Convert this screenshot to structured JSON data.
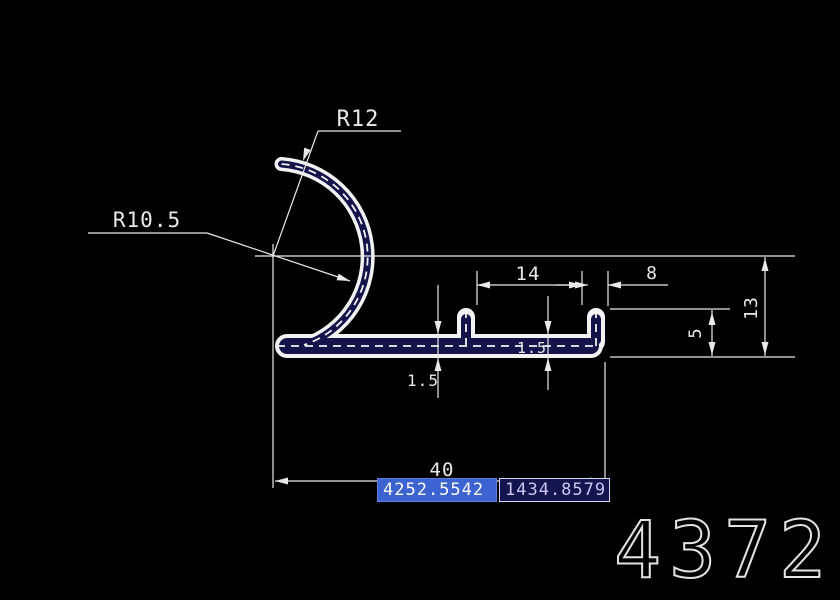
{
  "labels": {
    "radius_outer": "R12",
    "radius_inner": "R10.5"
  },
  "dimensions": {
    "tab_to_lip": "14",
    "lip_width": "8",
    "right_height": "13",
    "lip_height": "5",
    "wall_thickness_left": "1.5",
    "wall_thickness_right": "1.5",
    "overall_width": "40"
  },
  "dynamic_input": {
    "x_coordinate": "4252.5542",
    "y_coordinate": "1434.8579"
  },
  "drawing_number": "4372",
  "colors": {
    "background": "#000000",
    "line": "#e9e9e9",
    "profile_fill": "#14144a",
    "input_active_bg": "#3c63cf",
    "input_idle_bg": "#14144e"
  }
}
